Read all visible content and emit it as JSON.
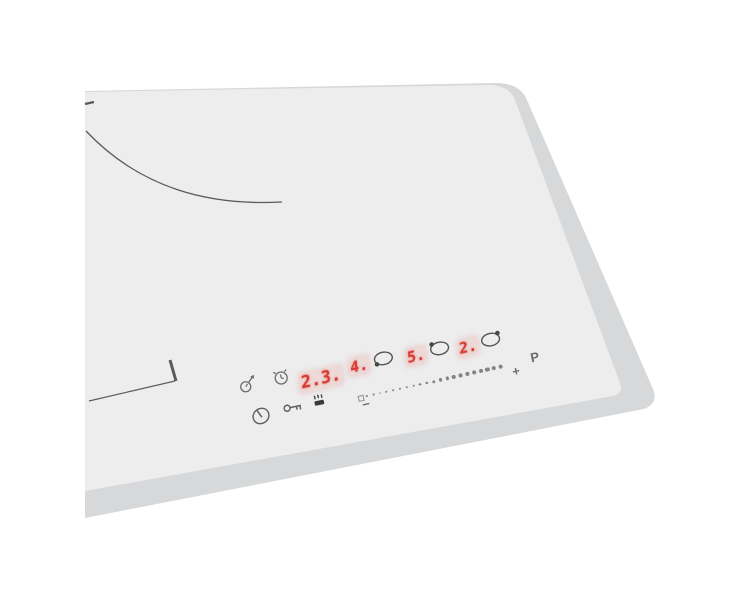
{
  "colors": {
    "background": "#ffffff",
    "glass_surface": "#ededee",
    "edge_bevel": "#d6d8d9",
    "marking_line": "#5a5a5a",
    "icon_gray": "#6a6a6a",
    "icon_dark": "#3a3a3a",
    "led_red": "#d93a31",
    "slider_dot": "#848484"
  },
  "panel": {
    "timer": {
      "display": "2.3.",
      "minute_minder_icon": "clock-with-arrow",
      "alarm_icon": "kitchen-timer-clock"
    },
    "zones": [
      {
        "level": "4.",
        "indicator_icon": "zone-circle-dot-bottom-left"
      },
      {
        "level": "5.",
        "indicator_icon": "zone-circle-dot-top-left"
      },
      {
        "level": "2.",
        "indicator_icon": "zone-circle-dot-top-right"
      }
    ],
    "slider": {
      "minus_label": "−",
      "plus_label": "+",
      "boost_label": "P",
      "dot_count": 21
    },
    "buttons": {
      "power_icon": "power-circle-with-bar",
      "lock_icon": "key",
      "pause_icon": "pot-with-steam"
    }
  }
}
